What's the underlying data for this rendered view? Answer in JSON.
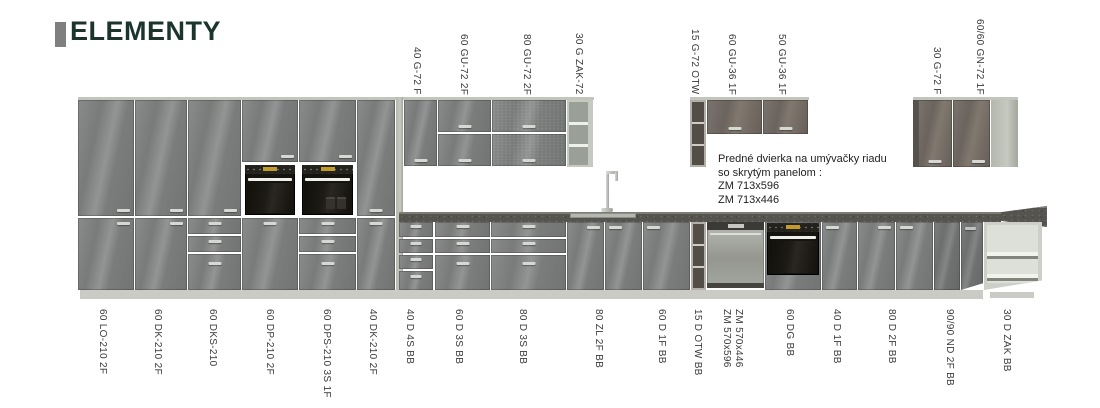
{
  "header": {
    "title": "ELEMENTY"
  },
  "note": {
    "text": "Predné dvierka na umývačky riadu\nso skrytým panelom :\nZM 713x596\nZM 713x446"
  },
  "top_labels": [
    {
      "text": "40 G-72 F",
      "x": 410
    },
    {
      "text": "60 GU-72 2F",
      "x": 457
    },
    {
      "text": "80 GU-72 2F",
      "x": 520
    },
    {
      "text": "30 G ZAK-72",
      "x": 572
    },
    {
      "text": "15 G-72 OTW",
      "x": 688
    },
    {
      "text": "60 GU-36 1F",
      "x": 725
    },
    {
      "text": "50 GU-36 1F",
      "x": 775
    },
    {
      "text": "30 G-72 F",
      "x": 930
    },
    {
      "text": "60/60 GN-72 1F",
      "x": 973
    }
  ],
  "bottom_labels": [
    {
      "text": "60 LO-210 2F",
      "x": 96
    },
    {
      "text": "60 DK-210 2F",
      "x": 151
    },
    {
      "text": "60 DKS-210",
      "x": 206
    },
    {
      "text": "60 DP-210 2F",
      "x": 263
    },
    {
      "text": "60 DPS-210 3S 1F",
      "x": 320
    },
    {
      "text": "40 DK-210 2F",
      "x": 366
    },
    {
      "text": "40 D 4S BB",
      "x": 403
    },
    {
      "text": "60 D 3S BB",
      "x": 452
    },
    {
      "text": "80 D 3S BB",
      "x": 516
    },
    {
      "text": "80 ZL 2F BB",
      "x": 592
    },
    {
      "text": "60 D 1F BB",
      "x": 655
    },
    {
      "text": "15 D OTW BB",
      "x": 691
    },
    {
      "lines": [
        "ZM 570x596",
        "ZM 570x446"
      ],
      "x": 720
    },
    {
      "text": "60 DG BB",
      "x": 783
    },
    {
      "text": "40 D 1F BB",
      "x": 830
    },
    {
      "text": "80 D 2F BB",
      "x": 885
    },
    {
      "text": "90/90 ND 2F BB",
      "x": 943
    },
    {
      "text": "30 D ZAK BB",
      "x": 1000
    }
  ],
  "colors": {
    "title_color": "#1b352e",
    "accent_bar": "#7f7f7f",
    "door_gray": "#7c7e7d",
    "door_taupe": "#6e665f",
    "carcass": "#c2c5bc",
    "counter": "#55544e",
    "plinth": "#c9cbc4",
    "oven": "#16140f",
    "oven_display": "#c39b2a",
    "handle": "#d6d8d4"
  }
}
